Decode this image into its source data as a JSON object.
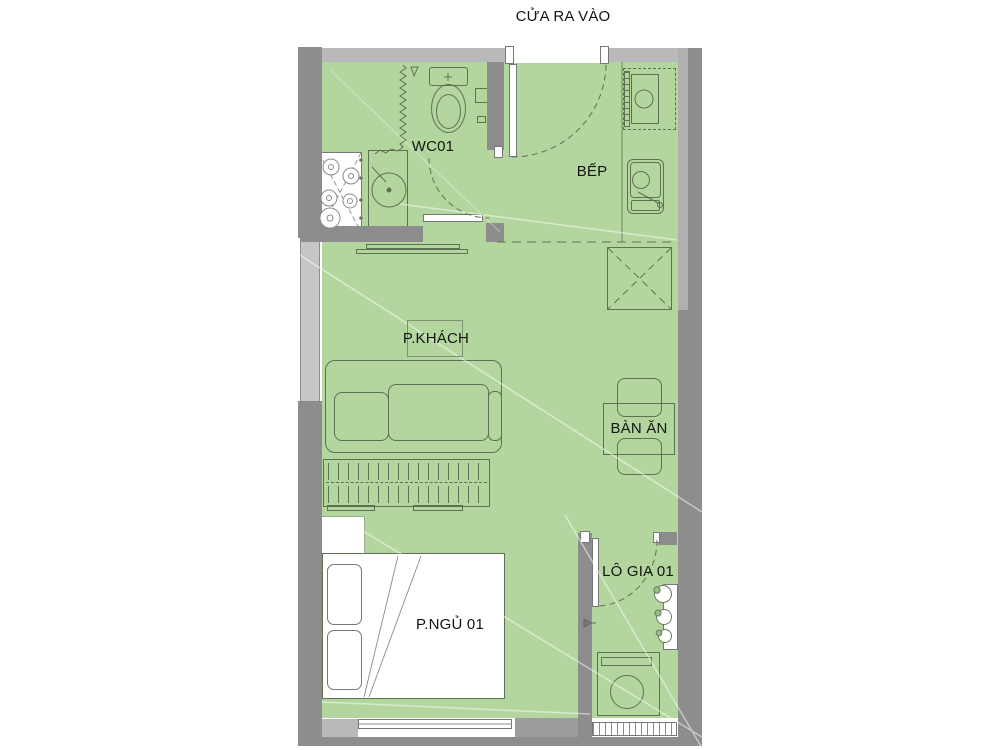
{
  "title": "CỬA RA VÀO",
  "rooms": [
    {
      "id": "wc",
      "label": "WC01"
    },
    {
      "id": "kitchen",
      "label": "BẾP"
    },
    {
      "id": "living",
      "label": "P.KHÁCH"
    },
    {
      "id": "dining",
      "label": "BÀN ĂN"
    },
    {
      "id": "bedroom",
      "label": "P.NGỦ 01"
    },
    {
      "id": "loggia",
      "label": "LÔ GIA 01"
    }
  ],
  "colors": {
    "floor": "#b2d69e",
    "wall_dark": "#8d8d8d",
    "wall_light": "#b9b9b9",
    "window_band": "#c6c6c6",
    "outline": "#5f7153",
    "background": "#ffffff",
    "text": "#141414"
  }
}
